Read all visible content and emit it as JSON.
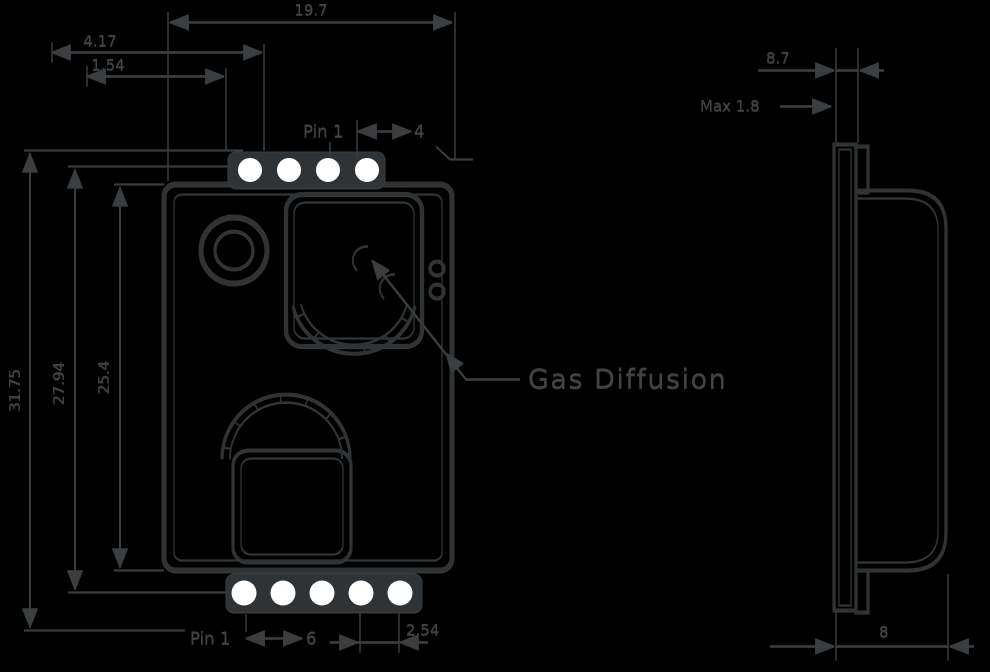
{
  "colors": {
    "background": "#000000",
    "line": "#2f3335",
    "line_soft": "#3a3e41",
    "text": "#404447",
    "pin_fill": "#ffffff",
    "glint": "rgba(255,255,255,0.22)"
  },
  "annotation": {
    "label": "Gas Diffusion"
  },
  "front_view": {
    "overall_width": "19.7",
    "pin_offset_dim": "4.17",
    "pin_offset_dim_2": "1.54",
    "overall_height": "31.75",
    "pin_span_height": "27.94",
    "body_height": "25.4",
    "top_pin_label": "Pin 1",
    "top_pin_last": "4",
    "bottom_pin_label": "Pin 1",
    "bottom_pin_last": "6",
    "pin_pitch": "2.54",
    "top_pin_count": 4,
    "bottom_pin_count": 5
  },
  "side_view": {
    "depth_with_lip": "8.7",
    "lip_max": "Max 1.8",
    "body_depth": "8"
  }
}
